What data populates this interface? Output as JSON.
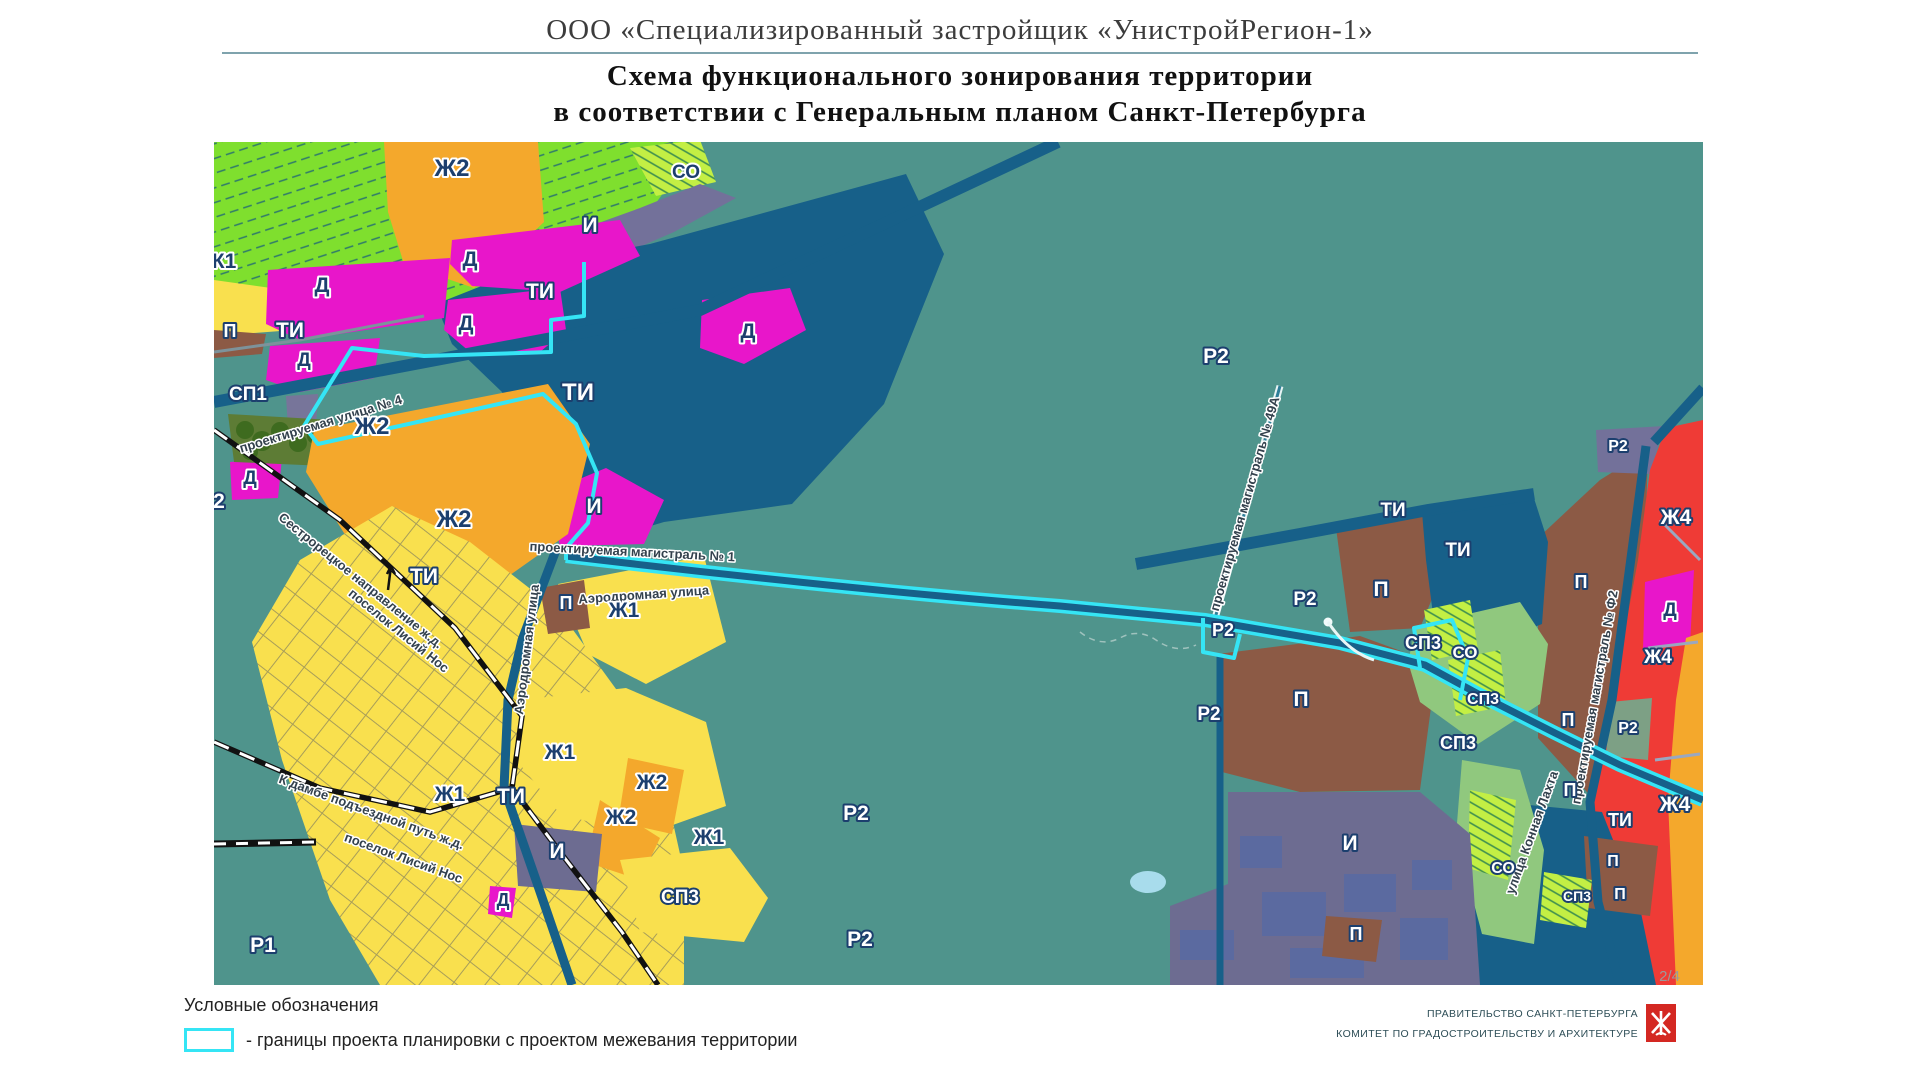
{
  "header": {
    "org_title": "ООО  «Специализированный  застройщик  «УнистройРегион-1»",
    "scheme_line1": "Схема функционального зонирования территории",
    "scheme_line2": "в соответствии  с Генеральным  планом  Санкт-Петербурга"
  },
  "legend": {
    "title": "Условные обозначения",
    "item_label": "- границы проекта планировки с проектом межевания территории",
    "boundary_color": "#35e5f5"
  },
  "footer": {
    "page": "2/4",
    "authority_line1": "ПРАВИТЕЛЬСТВО  САНКТ-ПЕТЕРБУРГА",
    "authority_line2": "КОМИТЕТ  ПО  ГРАДОСТРОИТЕЛЬСТВУ  И  АРХИТЕКТУРЕ"
  },
  "map": {
    "colors": {
      "background_teal": "#4f948c",
      "residential_low_yellow": "#f9e04e",
      "residential_mid_orange": "#f4a82c",
      "residential_high_red": "#ef3b36",
      "business_magenta": "#e816ca",
      "transport_dark_blue": "#176089",
      "engineering_grey_purple": "#73719a",
      "industrial_brown": "#8c5a45",
      "garden_green": "#7fdf2e",
      "special_green": "#c3ef44",
      "project_boundary_cyan": "#35e5f5"
    },
    "zone_labels": [
      {
        "t": "К1",
        "x": 224,
        "y": 268,
        "st": "d"
      },
      {
        "t": "Ж2",
        "x": 452,
        "y": 176,
        "st": "d",
        "s": 24
      },
      {
        "t": "СО",
        "x": 686,
        "y": 178,
        "st": "d",
        "s": 19
      },
      {
        "t": "И",
        "x": 590,
        "y": 232,
        "st": "l"
      },
      {
        "t": "Д",
        "x": 322,
        "y": 292,
        "st": "d"
      },
      {
        "t": "Д",
        "x": 470,
        "y": 266,
        "st": "d"
      },
      {
        "t": "ТИ",
        "x": 540,
        "y": 298,
        "st": "l"
      },
      {
        "t": "Д",
        "x": 466,
        "y": 330,
        "st": "d"
      },
      {
        "t": "ТИ",
        "x": 290,
        "y": 337,
        "st": "l"
      },
      {
        "t": "П",
        "x": 230,
        "y": 337,
        "st": "l",
        "s": 18
      },
      {
        "t": "Д",
        "x": 304,
        "y": 366,
        "st": "d",
        "s": 19
      },
      {
        "t": "Д",
        "x": 748,
        "y": 338,
        "st": "d"
      },
      {
        "t": "СП1",
        "x": 248,
        "y": 400,
        "st": "l",
        "s": 19
      },
      {
        "t": "Ж2",
        "x": 372,
        "y": 434,
        "st": "d",
        "s": 24
      },
      {
        "t": "Д",
        "x": 250,
        "y": 484,
        "st": "d",
        "s": 19
      },
      {
        "t": "2",
        "x": 219,
        "y": 508,
        "st": "l"
      },
      {
        "t": "Ж2",
        "x": 454,
        "y": 527,
        "st": "d",
        "s": 24
      },
      {
        "t": "ТИ",
        "x": 578,
        "y": 400,
        "st": "l",
        "s": 24
      },
      {
        "t": "И",
        "x": 594,
        "y": 513,
        "st": "l"
      },
      {
        "t": "ТИ",
        "x": 424,
        "y": 583,
        "st": "l"
      },
      {
        "t": "П",
        "x": 566,
        "y": 609,
        "st": "l",
        "s": 18
      },
      {
        "t": "Ж1",
        "x": 624,
        "y": 617,
        "st": "d"
      },
      {
        "t": "Ж1",
        "x": 560,
        "y": 759,
        "st": "d"
      },
      {
        "t": "Ж2",
        "x": 652,
        "y": 789,
        "st": "d"
      },
      {
        "t": "Ж1",
        "x": 450,
        "y": 801,
        "st": "d"
      },
      {
        "t": "ТИ",
        "x": 511,
        "y": 803,
        "st": "l"
      },
      {
        "t": "Ж2",
        "x": 621,
        "y": 824,
        "st": "d"
      },
      {
        "t": "Ж1",
        "x": 709,
        "y": 844,
        "st": "d"
      },
      {
        "t": "И",
        "x": 557,
        "y": 858,
        "st": "l"
      },
      {
        "t": "Д",
        "x": 503,
        "y": 906,
        "st": "d",
        "s": 18
      },
      {
        "t": "СП3",
        "x": 680,
        "y": 903,
        "st": "l",
        "s": 19
      },
      {
        "t": "Р1",
        "x": 263,
        "y": 952,
        "st": "l"
      },
      {
        "t": "Р2",
        "x": 856,
        "y": 820,
        "st": "l"
      },
      {
        "t": "Р2",
        "x": 860,
        "y": 946,
        "st": "l"
      },
      {
        "t": "Р2",
        "x": 1216,
        "y": 363,
        "st": "l"
      },
      {
        "t": "Р2",
        "x": 1305,
        "y": 605,
        "st": "l",
        "s": 19
      },
      {
        "t": "Р2",
        "x": 1223,
        "y": 636,
        "st": "l",
        "s": 18
      },
      {
        "t": "ТИ",
        "x": 1393,
        "y": 516,
        "st": "l",
        "s": 19
      },
      {
        "t": "ТИ",
        "x": 1458,
        "y": 556,
        "st": "l",
        "s": 19
      },
      {
        "t": "П",
        "x": 1381,
        "y": 596,
        "st": "l"
      },
      {
        "t": "П",
        "x": 1581,
        "y": 588,
        "st": "l",
        "s": 18
      },
      {
        "t": "СП3",
        "x": 1423,
        "y": 649,
        "st": "l",
        "s": 18
      },
      {
        "t": "СО",
        "x": 1465,
        "y": 658,
        "st": "l",
        "s": 17
      },
      {
        "t": "Р2",
        "x": 1209,
        "y": 720,
        "st": "l",
        "s": 19
      },
      {
        "t": "П",
        "x": 1301,
        "y": 706,
        "st": "l"
      },
      {
        "t": "СП3",
        "x": 1483,
        "y": 704,
        "st": "l",
        "s": 16
      },
      {
        "t": "СП3",
        "x": 1458,
        "y": 749,
        "st": "l",
        "s": 18
      },
      {
        "t": "П",
        "x": 1568,
        "y": 726,
        "st": "l",
        "s": 18
      },
      {
        "t": "П",
        "x": 1570,
        "y": 796,
        "st": "l",
        "s": 18
      },
      {
        "t": "И",
        "x": 1350,
        "y": 850,
        "st": "l"
      },
      {
        "t": "СО",
        "x": 1503,
        "y": 873,
        "st": "l",
        "s": 16
      },
      {
        "t": "П",
        "x": 1356,
        "y": 940,
        "st": "l",
        "s": 18
      },
      {
        "t": "Р2",
        "x": 1618,
        "y": 451,
        "st": "l",
        "s": 16
      },
      {
        "t": "Ж4",
        "x": 1676,
        "y": 524,
        "st": "l"
      },
      {
        "t": "Д",
        "x": 1670,
        "y": 616,
        "st": "d",
        "s": 19
      },
      {
        "t": "Ж4",
        "x": 1658,
        "y": 663,
        "st": "l",
        "s": 19
      },
      {
        "t": "Р2",
        "x": 1628,
        "y": 733,
        "st": "l",
        "s": 16
      },
      {
        "t": "Ж4",
        "x": 1675,
        "y": 811,
        "st": "l"
      },
      {
        "t": "ТИ",
        "x": 1620,
        "y": 826,
        "st": "l",
        "s": 18
      },
      {
        "t": "П",
        "x": 1613,
        "y": 866,
        "st": "l",
        "s": 16
      },
      {
        "t": "СП3",
        "x": 1577,
        "y": 901,
        "st": "l",
        "s": 14
      },
      {
        "t": "П",
        "x": 1620,
        "y": 899,
        "st": "l",
        "s": 16
      }
    ],
    "street_labels": [
      {
        "t": "проектируемая улица № 4",
        "x": 322,
        "y": 428,
        "r": -17
      },
      {
        "t": "Сестрорецкое направление ж.д.",
        "x": 358,
        "y": 584,
        "r": 39
      },
      {
        "t": "поселок Лисий Нос",
        "x": 396,
        "y": 634,
        "r": 39
      },
      {
        "t": "Аэродромная улица",
        "x": 531,
        "y": 650,
        "r": -83
      },
      {
        "t": "Аэродромная улица",
        "x": 644,
        "y": 599,
        "r": -4
      },
      {
        "t": "проектируемая магистраль № 1",
        "x": 632,
        "y": 556,
        "r": 3
      },
      {
        "t": "К дамбе подъездной путь ж.д.",
        "x": 370,
        "y": 816,
        "r": 20
      },
      {
        "t": "поселок Лисий Нос",
        "x": 402,
        "y": 862,
        "r": 20
      },
      {
        "t": "проектируемая магистраль № 49А",
        "x": 1249,
        "y": 505,
        "r": -74
      },
      {
        "t": "проектируемая магистраль № Ф2",
        "x": 1599,
        "y": 698,
        "r": -80
      },
      {
        "t": "улица Конная Лахта",
        "x": 1536,
        "y": 834,
        "r": -70
      }
    ]
  }
}
